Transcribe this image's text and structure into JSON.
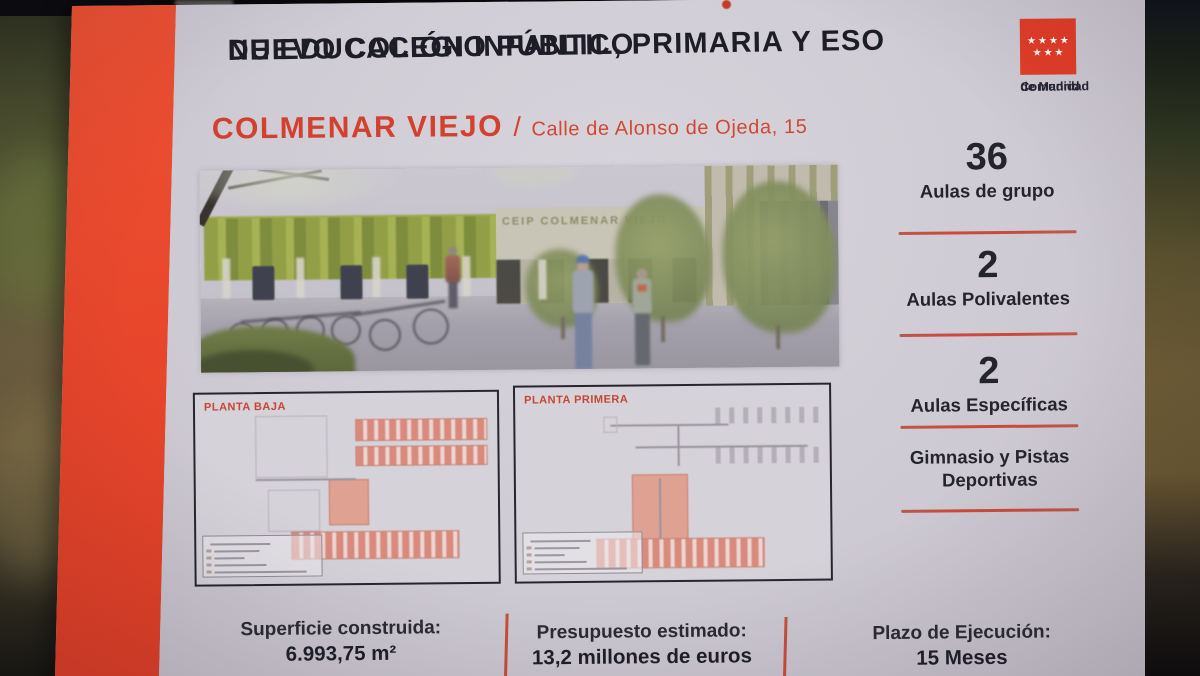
{
  "colors": {
    "stripe_red": "#e8472c",
    "accent_red": "#d2402f",
    "divider_red": "#c74c3f",
    "text_navy": "#1d1d28",
    "sign_bg": "#cfcbd4",
    "green_wall": "#97a63a"
  },
  "sign": {
    "title": {
      "line1": "NUEVO COLEGIO PÚBLICO",
      "line2": "DE EDUCACIÓN INFANTIL, PRIMARIA Y ESO"
    },
    "location": {
      "city": "COLMENAR VIEJO",
      "separator": "/",
      "address": "Calle de Alonso de Ojeda, 15"
    },
    "logo": {
      "line1": "Comunidad",
      "line2": "de Madrid",
      "stars_row1": "★★★★",
      "stars_row2": "★★★"
    },
    "render": {
      "building_caption": "CEIP COLMENAR VIEJO"
    },
    "plans": [
      {
        "label": "PLANTA BAJA"
      },
      {
        "label": "PLANTA PRIMERA"
      }
    ],
    "stats": [
      {
        "value": "36",
        "label": "Aulas de grupo"
      },
      {
        "value": "2",
        "label": "Aulas Polivalentes"
      },
      {
        "value": "2",
        "label": "Aulas Específicas"
      },
      {
        "value": "",
        "label": "Gimnasio y Pistas Deportivas"
      }
    ],
    "footer": [
      {
        "label": "Superficie construida:",
        "value": "6.993,75 m²"
      },
      {
        "label": "Presupuesto estimado:",
        "value": "13,2 millones de euros"
      },
      {
        "label": "Plazo de Ejecución:",
        "value": "15 Meses"
      }
    ]
  }
}
